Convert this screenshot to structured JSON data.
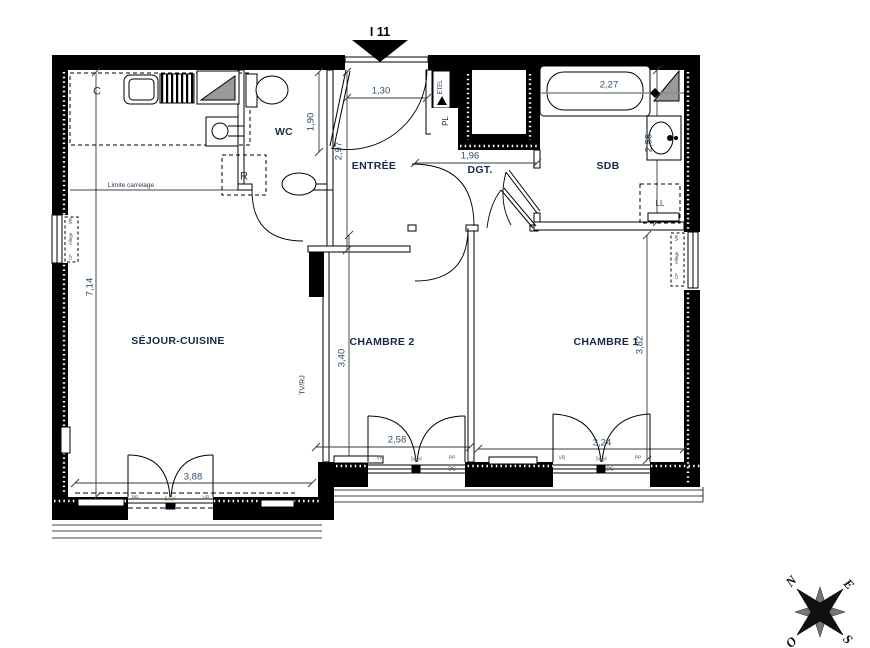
{
  "title": "I 11",
  "rooms": {
    "sejour": "SÉJOUR-CUISINE",
    "chambre2": "CHAMBRE 2",
    "chambre1": "CHAMBRE 1",
    "entree": "ENTRÉE",
    "dgt": "DGT.",
    "sdb": "SDB",
    "wc": "WC"
  },
  "fixtures": {
    "kitchen_c": "C",
    "fridge": "R",
    "closet": "PL",
    "washer": "LL",
    "etel": "ETEL",
    "tv_outlet": "TV/RJ"
  },
  "notes": {
    "tiling_limit": "Limite carrelage",
    "sill": "Seuil",
    "vr": "VR",
    "pp": "PP",
    "dc": "DC",
    "allege": "Allège",
    "cf": "CF"
  },
  "dims": {
    "entry_door": "1,30",
    "wc_depth": "1,90",
    "entree_len": "2,97",
    "dgt_width": "1,96",
    "bath": "2,27",
    "sdb_depth": "2,55",
    "sejour_height": "7,14",
    "sejour_door": "3,88",
    "ch2_height": "3,40",
    "ch2_width": "2,58",
    "ch1_height": "3,82",
    "ch1_width": "3,24"
  },
  "compass": {
    "n": "N",
    "e": "E",
    "s": "S",
    "o": "O"
  },
  "colors": {
    "wall": "#000000",
    "ink": "#152a4a",
    "dim_ink": "#2f4f6e",
    "shade": "#9a9a9a"
  }
}
